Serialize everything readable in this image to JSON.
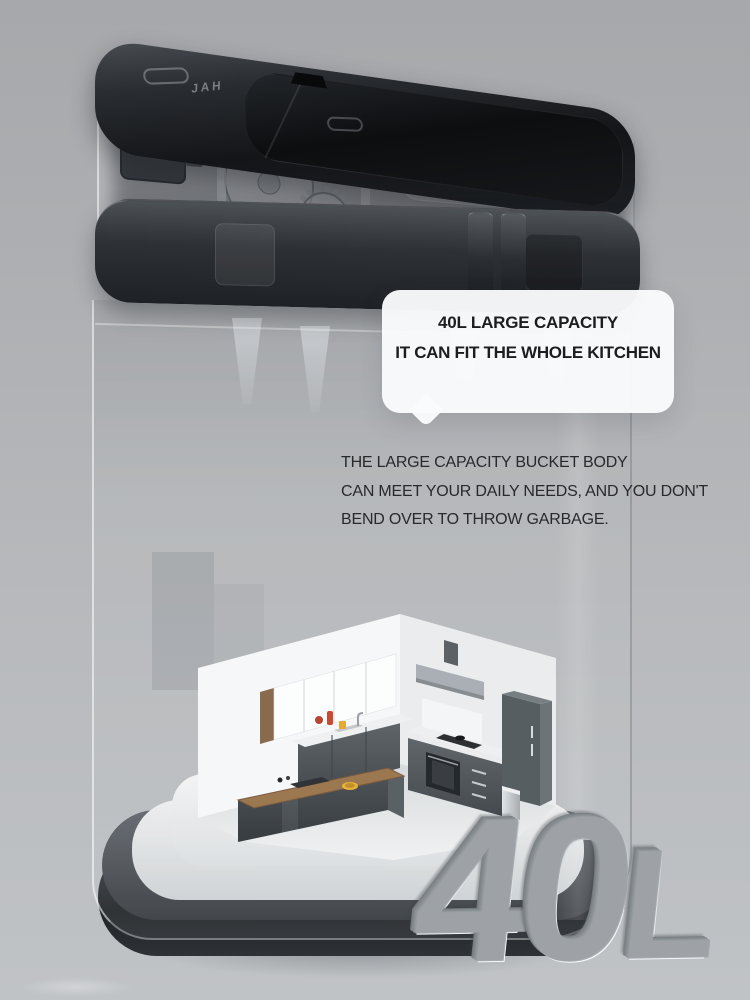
{
  "lid": {
    "brand_text": "JAH"
  },
  "callout": {
    "line1": "40L LARGE CAPACITY",
    "line2": "IT CAN FIT THE WHOLE KITCHEN"
  },
  "caption": {
    "line1": "THE LARGE CAPACITY BUCKET BODY",
    "line2": "CAN MEET YOUR DAILY NEEDS, AND YOU DON'T",
    "line3": "BEND OVER TO THROW GARBAGE."
  },
  "capacity": {
    "text": "40L",
    "letters": [
      "4",
      "0",
      "L"
    ]
  },
  "colors": {
    "background_top": "#a6a8ab",
    "background_bottom": "#c0c3c6",
    "lid_dark": "#131518",
    "rim_band": "#2d3034",
    "bubble_bg": "#fafbfc",
    "text_dark": "#1c1d1f",
    "metal_light": "#eef0f1",
    "kitchen_cabinet": "#565d61",
    "kitchen_wood": "#9c7851",
    "steel": "#c9cdd0"
  }
}
